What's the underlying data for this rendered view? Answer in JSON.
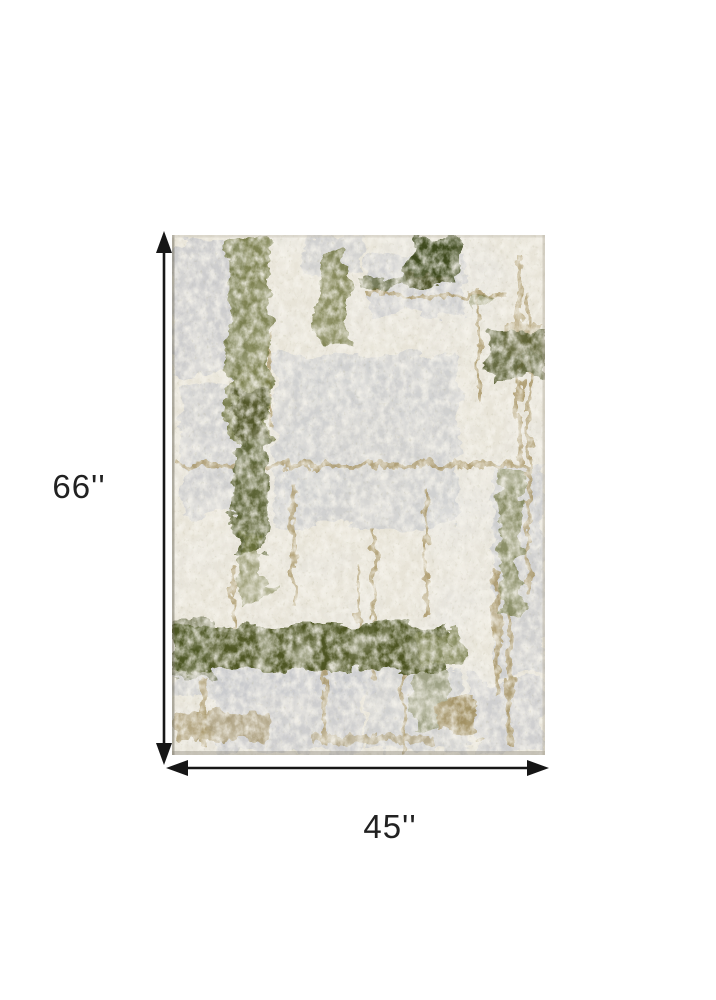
{
  "diagram": {
    "height_label": "66''",
    "width_label": "45''",
    "product_image": "abstract-distressed-area-rug",
    "colors": {
      "arrow_color": "#161616",
      "label_color": "#212121",
      "ivory": "#e8e4d8",
      "gray": "#c8c9cd",
      "olive_dark": "#4d5424",
      "olive_mid": "#6b7138",
      "olive_deep": "#3d481e",
      "khaki": "#a5925f",
      "tan": "#9c8a58"
    }
  }
}
